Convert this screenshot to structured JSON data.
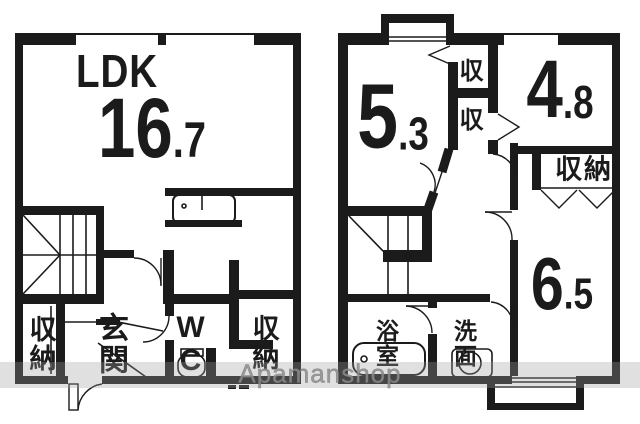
{
  "first_floor": {
    "ldk_label": "LDK",
    "area_int": "16",
    "area_dec": ".7",
    "closet_left": "収納",
    "entrance": "玄関",
    "wc": "WC",
    "closet_right": "収納"
  },
  "second_floor": {
    "room_a_int": "5",
    "room_a_dec": ".3",
    "closet_a": "収",
    "closet_b": "収",
    "room_b_int": "4",
    "room_b_dec": ".8",
    "closet_label": "収納",
    "room_c_int": "6",
    "room_c_dec": ".5",
    "bathroom": "浴室",
    "washroom": "洗面"
  },
  "watermark": {
    "text": "Apamanshop"
  },
  "colors": {
    "walls": "#1b1b1b",
    "background": "#ffffff",
    "watermark_text": "#8e8e8e",
    "watermark_band": "rgba(160,160,160,0.32)"
  }
}
